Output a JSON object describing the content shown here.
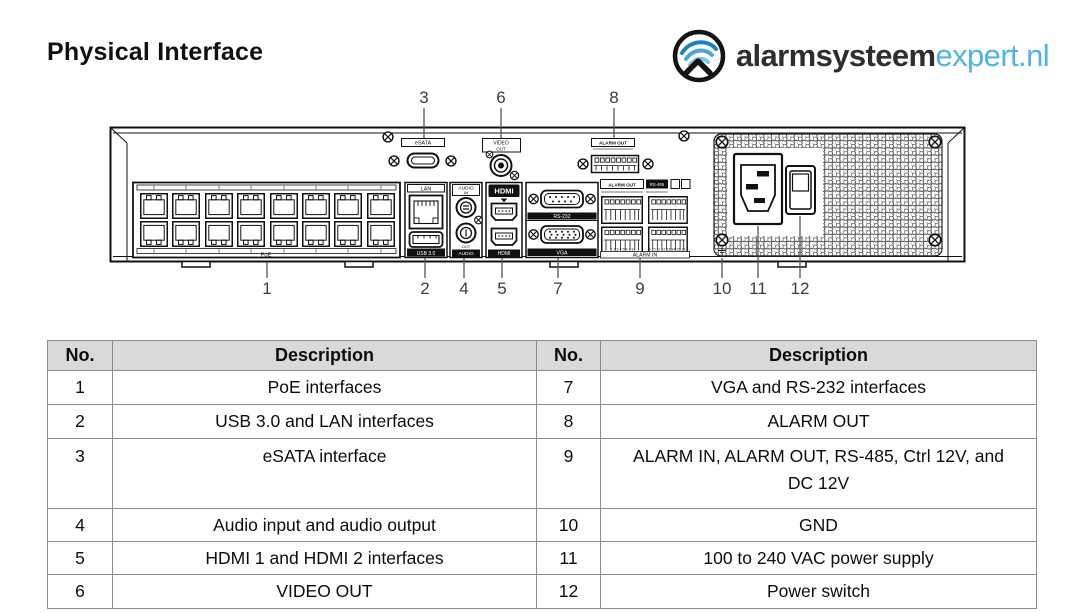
{
  "title": "Physical Interface",
  "logo": {
    "brand_bold": "alarmsysteem",
    "brand_light": "expert.nl",
    "accent_color": "#4fb3e3"
  },
  "diagram": {
    "callouts_top": [
      {
        "n": "3"
      },
      {
        "n": "6"
      },
      {
        "n": "8"
      }
    ],
    "callouts_bottom": [
      {
        "n": "1"
      },
      {
        "n": "2"
      },
      {
        "n": "4"
      },
      {
        "n": "5"
      },
      {
        "n": "7"
      },
      {
        "n": "9"
      },
      {
        "n": "10"
      },
      {
        "n": "11"
      },
      {
        "n": "12"
      }
    ],
    "labels": {
      "esata": "eSATA",
      "video": "VIDEO",
      "video_sub": "OUT",
      "alarm_out_top": "ALARM OUT",
      "lan": "LAN",
      "usb": "USB 3.0",
      "audio": "AUDIO",
      "audio_in": "IN",
      "audio_out": "OUT",
      "audio2": "AUDIO",
      "hdmi_logo": "HDMI",
      "hdmi": "HDMI",
      "rs232": "RS-232",
      "vga": "VGA",
      "alarm_out": "ALARM OUT",
      "rs485": "RS-485",
      "alarm_in": "ALARM IN",
      "alarm_in_numbers_left": "1 2 3 4 5 6 7 8",
      "alarm_in_numbers_right": "9 10 11 12 13 14 15 16",
      "poe": "PoE"
    }
  },
  "table": {
    "headers": {
      "no_left": "No.",
      "desc_left": "Description",
      "no_right": "No.",
      "desc_right": "Description"
    },
    "rows": [
      {
        "no_left": "1",
        "desc_left": "PoE interfaces",
        "no_right": "7",
        "desc_right": "VGA and RS-232 interfaces"
      },
      {
        "no_left": "2",
        "desc_left": "USB 3.0 and LAN interfaces",
        "no_right": "8",
        "desc_right": "ALARM OUT"
      },
      {
        "no_left": "3",
        "desc_left": "eSATA interface",
        "no_right": "9",
        "desc_right": "ALARM IN, ALARM OUT, RS-485, Ctrl 12V, and DC 12V"
      },
      {
        "no_left": "4",
        "desc_left": "Audio input and audio output",
        "no_right": "10",
        "desc_right": "GND"
      },
      {
        "no_left": "5",
        "desc_left": "HDMI 1 and HDMI 2 interfaces",
        "no_right": "11",
        "desc_right": "100 to 240 VAC power supply"
      },
      {
        "no_left": "6",
        "desc_left": "VIDEO OUT",
        "no_right": "12",
        "desc_right": "Power switch"
      }
    ]
  }
}
